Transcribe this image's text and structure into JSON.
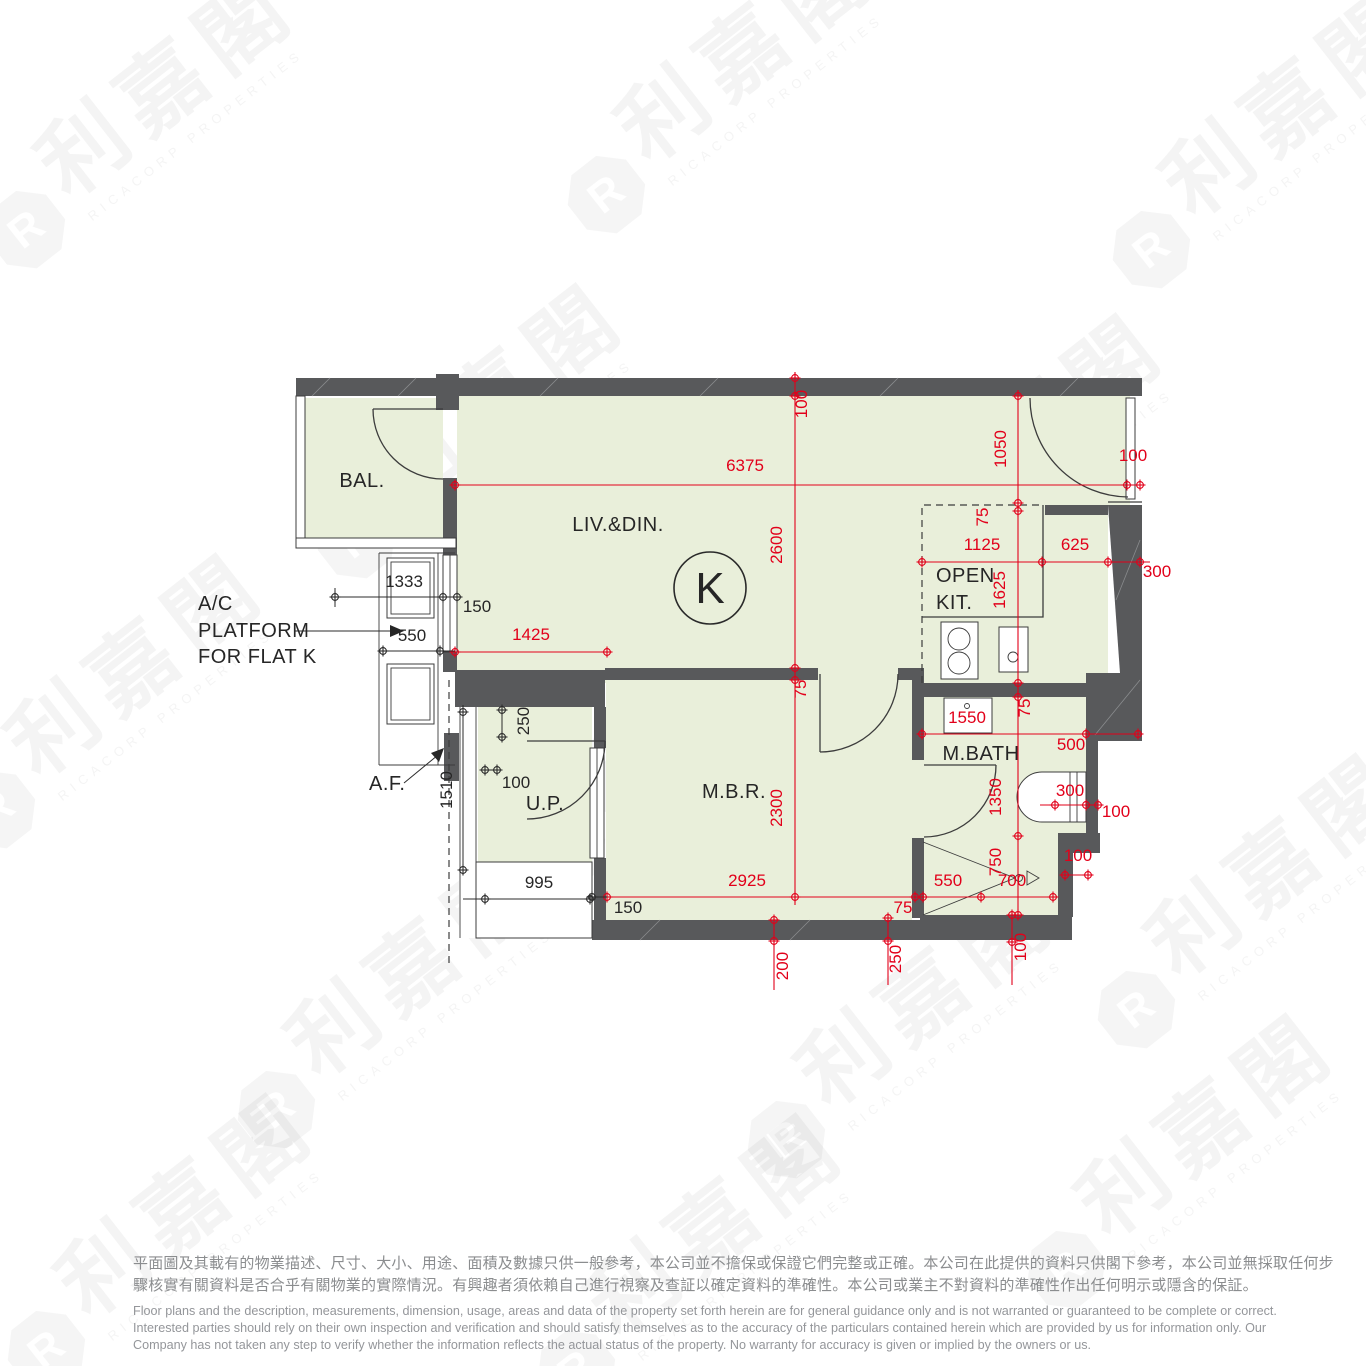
{
  "flat": {
    "designator": "K"
  },
  "rooms": {
    "balcony": "BAL.",
    "living_dining": "LIV.&DIN.",
    "open_kitchen_l1": "OPEN",
    "open_kitchen_l2": "KIT.",
    "master_bedroom": "M.B.R.",
    "master_bath": "M.BATH",
    "utility_platform": "U.P."
  },
  "annotations": {
    "ac_platform_l1": "A/C",
    "ac_platform_l2": "PLATFORM",
    "ac_platform_l3": "FOR FLAT K",
    "architectural_feature": "A.F."
  },
  "dims_red": {
    "top_wall": "100",
    "living_width": "6375",
    "living_depth": "2600",
    "entry_depth": "1050",
    "entry_door": "100",
    "kit_top": "75",
    "kit_width_left": "1125",
    "kit_width_right": "625",
    "right_wall": "300",
    "kit_depth": "1625",
    "liv_left": "1425",
    "mbr_wall": "75",
    "bath_wall": "75",
    "vanity": "1550",
    "bath_width": "500",
    "bath_depth": "1350",
    "tub": "300",
    "bath_right_wall": "100",
    "mbr_width": "2925",
    "mbr_depth": "2300",
    "shower_wall": "75",
    "shower_w1": "550",
    "shower_w2": "700",
    "shower_depth": "750",
    "step": "100",
    "bottom_wall": "100",
    "bottom_left": "200",
    "bottom_mid": "250"
  },
  "dims_black": {
    "ac_unit": "1333",
    "ac_width": "550",
    "wall": "150",
    "up_step": "250",
    "up_wall": "100",
    "af_length": "1510",
    "up_width": "995",
    "mbr_wall_left": "150"
  },
  "watermark": {
    "logo_letter": "R",
    "cjk": "利嘉閣",
    "en": "RICACORP PROPERTIES"
  },
  "disclaimer": {
    "zh1": "平面圖及其載有的物業描述、尺寸、大小、用途、面積及數據只供一般參考，本公司並不擔保或保證它們完整或正確。本公司在此提供的資料只供閣下參考，本公司並無採取任何步",
    "zh2": "驟核實有關資料是否合乎有關物業的實際情況。有興趣者須依賴自己進行視察及查証以確定資料的準確性。本公司或業主不對資料的準確性作出任何明示或隱含的保証。",
    "en1": "Floor plans and the description, measurements, dimension, usage, areas and data of the property set forth herein are for general guidance only and is not warranted or guaranteed to be complete or correct.",
    "en2": "Interested parties should rely on their own inspection and verification and should satisfy themselves as to the accuracy of the particulars contained herein which are provided by us for information only.  Our",
    "en3": "Company has not taken any step to verify whether the information reflects the actual status of the property.  No warranty for accuracy is given or implied by the owners or us."
  },
  "colors": {
    "room_fill": "#e9efda",
    "wall": "#58595b",
    "dim_red": "#e2001a",
    "text_black": "#262626",
    "disclaimer_gray": "#8b8d8f"
  }
}
